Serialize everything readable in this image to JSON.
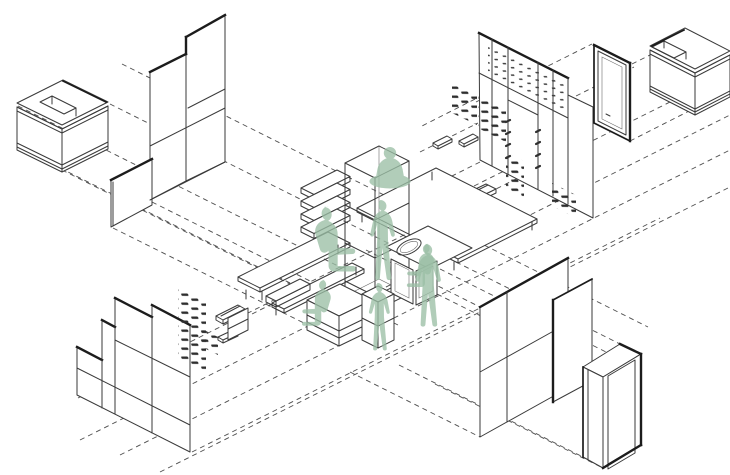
{
  "meta": {
    "description": "Exploded axonometric line diagram of a central kiosk interior: furniture and wall elements projected outward along the two isometric axes with dashed projection lines; green human silhouettes occupy the centre",
    "style": "architectural line drawing"
  },
  "colors": {
    "background": "#ffffff",
    "line": "#3a3a3a",
    "line_bold": "#1c1c1c",
    "dash": "#4d4d4d",
    "figure_green": "#9bbfa5"
  },
  "figures": {
    "count": 7,
    "poses": [
      "cross-legged-on-table",
      "standing-at-shelf-tower",
      "standing-at-sink",
      "seated-at-basin",
      "seated-on-bench",
      "seated-at-low-table",
      "standing-at-low-table"
    ]
  },
  "components": {
    "top_left": [
      "l-shaped-counter",
      "stepped-panel-wall"
    ],
    "top_center": [
      "pegboard-wall-with-opening",
      "peg-arrays",
      "floating-shelves"
    ],
    "top_right": [
      "framed-door",
      "l-shaped-counter"
    ],
    "bottom_left": [
      "stepped-panel-wall",
      "peg-array",
      "floating-shelves"
    ],
    "bottom_right": [
      "panel-wall",
      "bold-edge-panel",
      "portal-frame"
    ],
    "center": [
      "shelf-tower",
      "slab-stack",
      "long-table",
      "bench",
      "big-table",
      "sink-counter",
      "low-tables"
    ]
  }
}
